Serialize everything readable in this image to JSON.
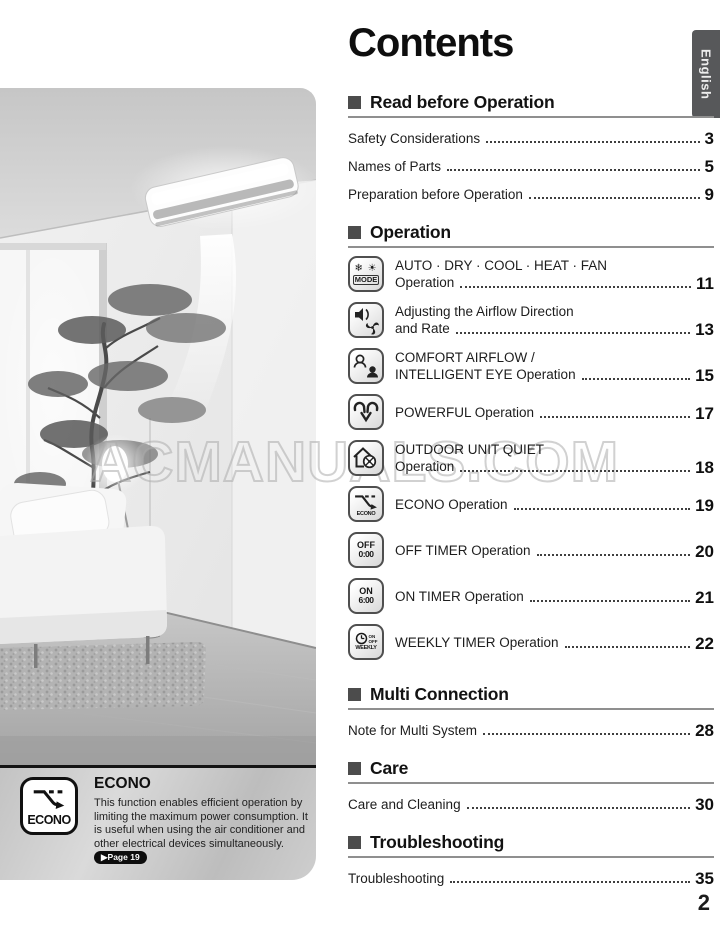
{
  "page": {
    "title": "Contents",
    "language_tab": "English",
    "page_number": "2",
    "watermark": "ACMANUALS.COM"
  },
  "toc": {
    "sections": [
      {
        "title": "Read before Operation",
        "items": [
          {
            "label": "Safety Considerations",
            "page": "3"
          },
          {
            "label": "Names of Parts",
            "page": "5"
          },
          {
            "label": "Preparation before Operation",
            "page": "9"
          }
        ]
      },
      {
        "title": "Operation",
        "items": [
          {
            "icon": "mode-icon",
            "line1": "AUTO · DRY · COOL · HEAT · FAN",
            "line2": "Operation",
            "page": "11"
          },
          {
            "icon": "airflow-icon",
            "line1": "Adjusting the Airflow Direction",
            "line2": "and Rate",
            "page": "13"
          },
          {
            "icon": "comfort-eye-icon",
            "line1": "COMFORT AIRFLOW /",
            "line2": "INTELLIGENT EYE Operation",
            "page": "15"
          },
          {
            "icon": "powerful-icon",
            "line1": "POWERFUL Operation",
            "page": "17"
          },
          {
            "icon": "outdoor-quiet-icon",
            "line1": "OUTDOOR UNIT QUIET",
            "line2": "Operation",
            "page": "18"
          },
          {
            "icon": "econo-icon",
            "line1": "ECONO Operation",
            "page": "19"
          },
          {
            "icon": "off-timer-icon",
            "line1": "OFF TIMER Operation",
            "page": "20"
          },
          {
            "icon": "on-timer-icon",
            "line1": "ON TIMER Operation",
            "page": "21"
          },
          {
            "icon": "weekly-timer-icon",
            "line1": "WEEKLY TIMER Operation",
            "page": "22"
          }
        ]
      },
      {
        "title": "Multi Connection",
        "items": [
          {
            "label": "Note for Multi System",
            "page": "28"
          }
        ]
      },
      {
        "title": "Care",
        "items": [
          {
            "label": "Care and Cleaning",
            "page": "30"
          }
        ]
      },
      {
        "title": "Troubleshooting",
        "items": [
          {
            "label": "Troubleshooting",
            "page": "35"
          }
        ]
      }
    ]
  },
  "icon_text": {
    "mode_glyphs": "❄ ☀",
    "mode": "MODE",
    "off_line1": "OFF",
    "off_line2": "0:00",
    "on_line1": "ON",
    "on_line2": "6:00",
    "weekly_on": "ON",
    "weekly_off": "OFF",
    "weekly": "WEEKLY",
    "econo": "ECONO"
  },
  "econo_panel": {
    "title": "ECONO",
    "icon_label": "ECONO",
    "body": "This function enables efficient operation by limiting the maximum power consumption. It is useful when using the air conditioner and other electrical devices simultaneously. ",
    "page_badge": "▶Page 19"
  },
  "colors": {
    "tab_bg": "#57585a",
    "header_rule": "#8f8f8f",
    "bullet": "#4c4c4c",
    "panel_gray": "#c9c9c9",
    "badge_bg": "#0d0d0d"
  }
}
